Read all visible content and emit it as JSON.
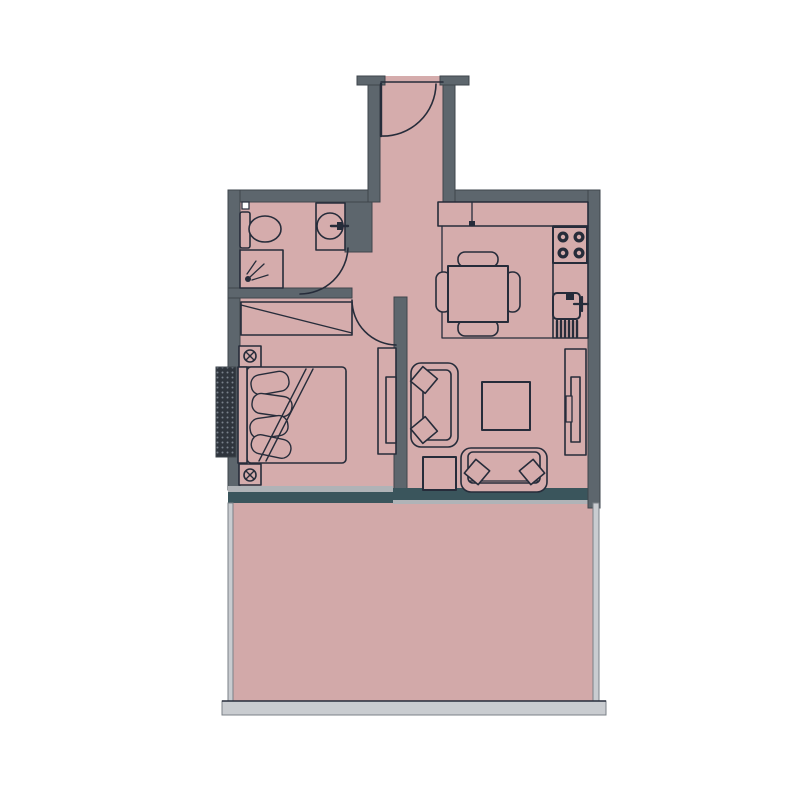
{
  "page": {
    "title": "Apartment Floor Plan",
    "type": "2d-architectural-floor-plan",
    "visible_text_labels": []
  },
  "colors": {
    "background": "#ffffff",
    "floor": "#d5acac",
    "balcony_floor": "#d2a9a9",
    "wall": "#5d666d",
    "wall_outline": "#3e454c",
    "line": "#262c3a",
    "window_wall": "#3a555c",
    "window_band": "#b0b3b7",
    "railing": "#c9ccd0",
    "railing_outline": "#7b8187",
    "ac_unit": "#2f353d"
  },
  "rooms": [
    {
      "id": "entrance-hall",
      "features": [
        "entry-door-swing"
      ]
    },
    {
      "id": "bathroom",
      "features": [
        "toilet",
        "round-washbasin-with-faucet",
        "shower-enclosure",
        "door-swing"
      ]
    },
    {
      "id": "kitchen-dining",
      "features": [
        "l-shaped-counter",
        "stove-4-burners",
        "kitchen-sink-with-faucet",
        "dish-drainer",
        "square-dining-table",
        "4-chairs"
      ]
    },
    {
      "id": "bedroom",
      "features": [
        "wardrobe",
        "double-bed-with-pillows",
        "nightstand-with-lamp-top",
        "nightstand-with-lamp-bottom",
        "tv-dresser",
        "ac-unit-on-wall",
        "door-swing"
      ]
    },
    {
      "id": "living-room",
      "features": [
        "two-seat-sofa-vertical",
        "loveseat-horizontal",
        "coffee-table",
        "side-table",
        "tv-unit"
      ]
    },
    {
      "id": "balcony",
      "features": [
        "glass-side-railings",
        "bottom-railing"
      ]
    }
  ]
}
